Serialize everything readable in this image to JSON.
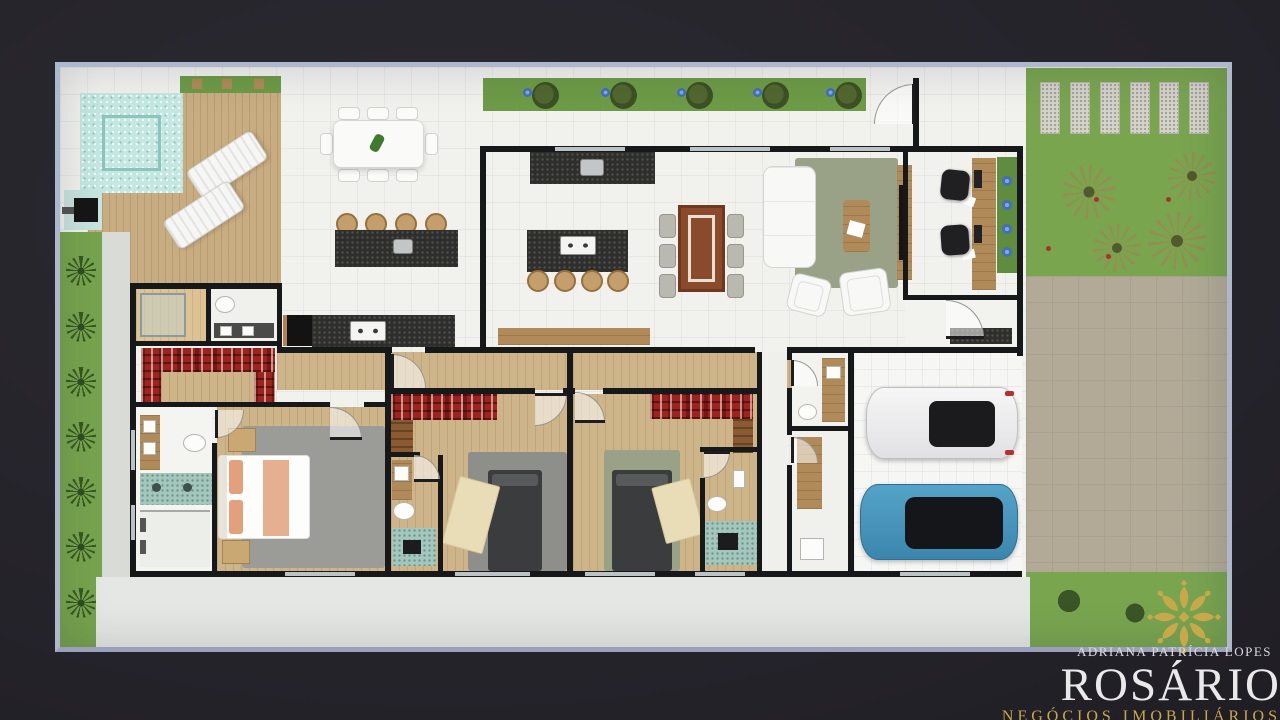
{
  "branding": {
    "owner": "ADRIANA PATRÍCIA LOPES",
    "brand": "ROSÁRIO",
    "tagline": "NEGÓCIOS IMOBILIÁRIOS"
  },
  "icons": {
    "rosette": "ornamental-gold-rosette"
  },
  "colors": {
    "background": "#242229",
    "frame": "#adb7cd",
    "paper": "#f1f2ee",
    "wall": "#17181a",
    "pool": "#c3e7e1",
    "pool_edge": "#8fc3bd",
    "grass": "#77a44e",
    "hedge": "#6d9b47",
    "lawn": "#79a54f",
    "walkway": "#d9dcd6",
    "deck_wood": "#c9ad82",
    "floor_wood": "#cdb489",
    "cabinet_wood": "#b08a58",
    "granite": "#2e2e2c",
    "teal": "#a3c6bd",
    "plaid": "#9c2420",
    "rug_gray": "#9b9b97",
    "rug_dark": "#8e8e8a",
    "rug_sage": "#99a186",
    "bed_dark": "#3a3c3e",
    "blanket": "#e9ddb8",
    "salmon": "#e2a17c",
    "car_blue": "#4796bd",
    "car_white": "#efefef",
    "driveway": "#b2aa97",
    "gold": "#c9a84c",
    "logo_text": "#e9e9ec"
  }
}
